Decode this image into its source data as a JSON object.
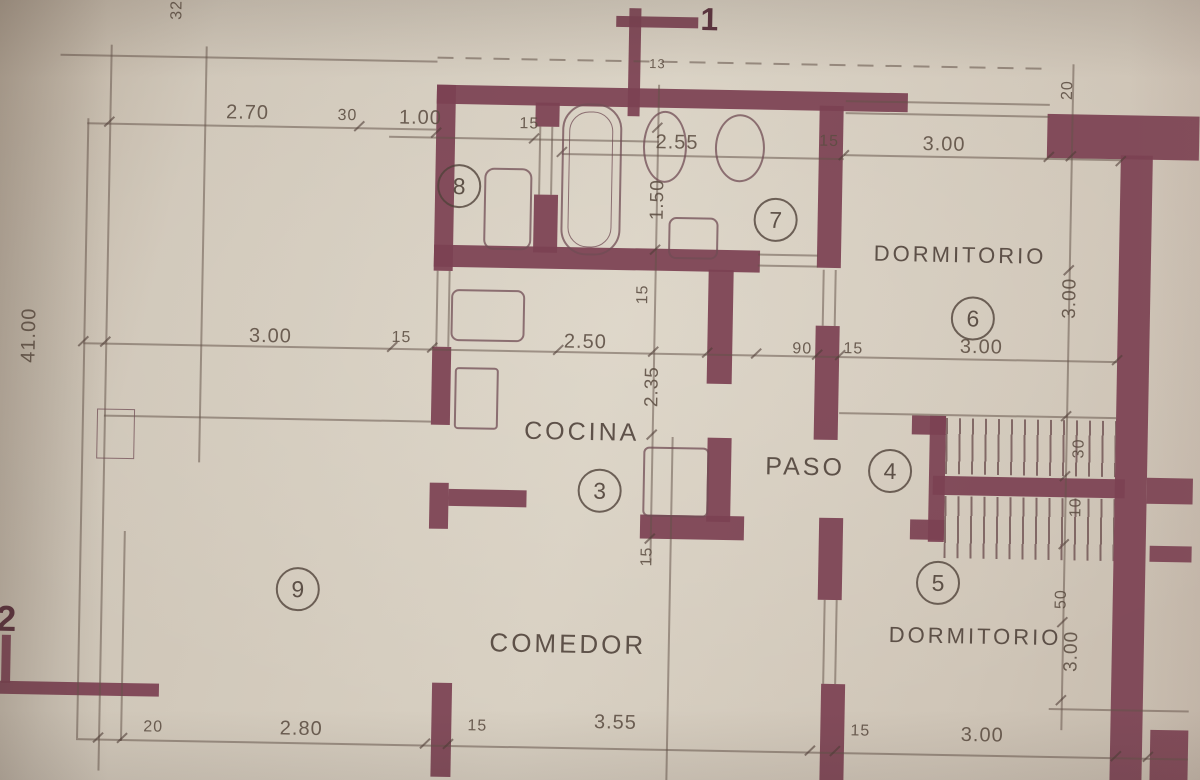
{
  "colors": {
    "paper": "#d4cbbd",
    "wall": "#7c4253",
    "pencil": "#6b5a4f"
  },
  "rooms": {
    "dormitorio6": {
      "label": "DORMITORIO",
      "num": "6"
    },
    "dormitorio5": {
      "label": "DORMITORIO",
      "num": "5"
    },
    "cocina": {
      "label": "COCINA",
      "num": "3"
    },
    "paso": {
      "label": "PASO",
      "num": "4"
    },
    "comedor": {
      "label": "COMEDOR"
    },
    "bath7": {
      "num": "7"
    },
    "bath8": {
      "num": "8"
    },
    "salon9": {
      "num": "9"
    }
  },
  "markers": {
    "m1": "1",
    "m2": "2"
  },
  "dims": {
    "d32": "32",
    "d270": "2.70",
    "d30": "30",
    "d100": "1.00",
    "d15a": "15",
    "d255": "2.55",
    "d15b": "15",
    "d300a": "3.00",
    "d20": "20",
    "d13": "13",
    "d150": "1.50",
    "d15c": "15",
    "d235": "2.35",
    "d15d": "15",
    "d4100": "41.00",
    "d300b": "3.00",
    "d15e": "15",
    "d250": "2.50",
    "d90": "90",
    "d15f": "15",
    "d300c": "3.00",
    "r300a": "3.00",
    "r30": "30",
    "r10": "10",
    "r50": "50",
    "r300b": "3.00",
    "b20": "20",
    "b280": "2.80",
    "b15a": "15",
    "b355": "3.55",
    "b15b": "15",
    "b300": "3.00"
  }
}
